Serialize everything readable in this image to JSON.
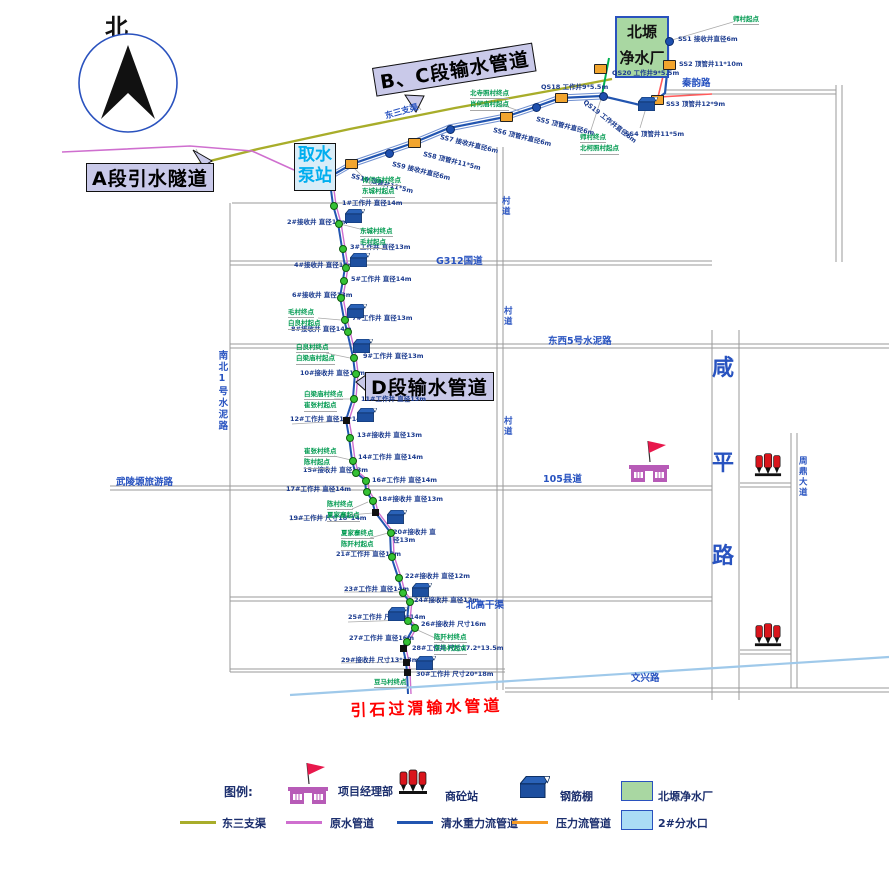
{
  "compass": {
    "label": "北"
  },
  "plant_box": {
    "line1": "北塬",
    "line2": "净水厂"
  },
  "pump_box": {
    "line1": "取水",
    "line2": "泵站"
  },
  "banners": {
    "a": "A段引水隧道",
    "bc": "B、C段输水管道",
    "d": "D段输水管道"
  },
  "red_pipeline_label": "引石过渭输水管道",
  "colors": {
    "road": "#9a9a9a",
    "clean_water": "#2255b0",
    "raw_water": "#cf6fcf",
    "pressure_map": "#ff5a5a",
    "pressure_legend": "#f59a23",
    "canal": "#a8ad2a",
    "branch_green": "#00b050",
    "yinshi": "#9fc9ea",
    "plant_green": "#a9d7a2",
    "outlet_blue": "#aadcf5",
    "label_blue": "#1b3b8f",
    "road_blue": "#2853c0",
    "village_green": "#009a50",
    "banner_fill": "#c9c9e9",
    "red_label": "#ff0000"
  },
  "ss_wells": [
    {
      "t": "SS1 接收井直径6m",
      "mx": 668,
      "my": 40,
      "lx": 678,
      "ly": 36,
      "mk": "dot",
      "rot": 0
    },
    {
      "t": "SS2 顶管井11*10m",
      "mx": 668,
      "my": 64,
      "lx": 679,
      "ly": 61,
      "mk": "box",
      "rot": 0
    },
    {
      "t": "SS3 顶管井12*9m",
      "mx": 656,
      "my": 99,
      "lx": 666,
      "ly": 101,
      "mk": "box",
      "rot": 0
    },
    {
      "t": "SS4 顶管井11*5m",
      "mx": 640,
      "my": 105,
      "lx": 625,
      "ly": 131,
      "mk": "none",
      "rot": 0
    },
    {
      "t": "QS20 工作井9*5.5m",
      "mx": 599,
      "my": 68,
      "lx": 612,
      "ly": 70,
      "mk": "box",
      "rot": 0
    },
    {
      "t": "QS19 工作井直径6m",
      "mx": 602,
      "my": 95,
      "lx": 586,
      "ly": 99,
      "mk": "dot",
      "rot": 38
    },
    {
      "t": "QS18 工作井9*5.5m",
      "mx": 560,
      "my": 97,
      "lx": 541,
      "ly": 84,
      "mk": "box",
      "rot": 0
    },
    {
      "t": "SS5 顶管井直径6m",
      "mx": 535,
      "my": 106,
      "lx": 537,
      "ly": 116,
      "mk": "dot",
      "rot": 14
    },
    {
      "t": "SS6 顶管井直径6m",
      "mx": 505,
      "my": 116,
      "lx": 494,
      "ly": 127,
      "mk": "box",
      "rot": 14
    },
    {
      "t": "SS7 接收井直径6m",
      "mx": 449,
      "my": 128,
      "lx": 441,
      "ly": 134,
      "mk": "dot",
      "rot": 14
    },
    {
      "t": "SS8 顶管井11*5m",
      "mx": 413,
      "my": 142,
      "lx": 424,
      "ly": 151,
      "mk": "box",
      "rot": 14
    },
    {
      "t": "SS9 接收井直径6m",
      "mx": 388,
      "my": 152,
      "lx": 393,
      "ly": 161,
      "mk": "dot",
      "rot": 14
    },
    {
      "t": "SS10 顶管井11*5m",
      "mx": 350,
      "my": 163,
      "lx": 352,
      "ly": 173,
      "mk": "box",
      "rot": 14
    }
  ],
  "numbered_wells": [
    {
      "t": "1#工作井  直径14m",
      "mx": 333,
      "my": 205,
      "lx": 342,
      "ly": 200,
      "mk": "g"
    },
    {
      "t": "2#接收井  直径13m",
      "mx": 338,
      "my": 223,
      "lx": 287,
      "ly": 219,
      "mk": "g"
    },
    {
      "t": "3#工作井  直径13m",
      "mx": 342,
      "my": 248,
      "lx": 350,
      "ly": 244,
      "mk": "g"
    },
    {
      "t": "4#接收井  直径14m",
      "mx": 345,
      "my": 267,
      "lx": 294,
      "ly": 262,
      "mk": "g"
    },
    {
      "t": "5#工作井  直径14m",
      "mx": 343,
      "my": 280,
      "lx": 351,
      "ly": 276,
      "mk": "g"
    },
    {
      "t": "6#接收井  直径13m",
      "mx": 340,
      "my": 297,
      "lx": 292,
      "ly": 292,
      "mk": "g"
    },
    {
      "t": "7#工作井  直径13m",
      "mx": 344,
      "my": 319,
      "lx": 352,
      "ly": 315,
      "mk": "g"
    },
    {
      "t": "8#接收井  直径14m",
      "mx": 347,
      "my": 331,
      "lx": 291,
      "ly": 326,
      "mk": "g"
    },
    {
      "t": "9#工作井  直径13m",
      "mx": 353,
      "my": 357,
      "lx": 363,
      "ly": 353,
      "mk": "g"
    },
    {
      "t": "10#接收井  直径13m",
      "mx": 355,
      "my": 373,
      "lx": 300,
      "ly": 370,
      "mk": "g"
    },
    {
      "t": "11#工作井  直径13m",
      "mx": 353,
      "my": 398,
      "lx": 361,
      "ly": 396,
      "mk": "g"
    },
    {
      "t": "12#工作井  直径18*14m",
      "mx": 346,
      "my": 420,
      "lx": 290,
      "ly": 416,
      "mk": "sq"
    },
    {
      "t": "13#接收井  直径13m",
      "mx": 349,
      "my": 437,
      "lx": 357,
      "ly": 432,
      "mk": "g"
    },
    {
      "t": "14#工作井  直径14m",
      "mx": 352,
      "my": 460,
      "lx": 358,
      "ly": 454,
      "mk": "g"
    },
    {
      "t": "15#接收井  直径13m",
      "mx": 355,
      "my": 472,
      "lx": 303,
      "ly": 467,
      "mk": "g"
    },
    {
      "t": "16#工作井  直径14m",
      "mx": 365,
      "my": 480,
      "lx": 372,
      "ly": 477,
      "mk": "g"
    },
    {
      "t": "17#工作井  直径14m",
      "mx": 366,
      "my": 491,
      "lx": 286,
      "ly": 486,
      "mk": "g"
    },
    {
      "t": "18#接收井  直径13m",
      "mx": 372,
      "my": 500,
      "lx": 378,
      "ly": 496,
      "mk": "g"
    },
    {
      "t": "19#工作井  尺寸18*14m",
      "mx": 375,
      "my": 512,
      "lx": 289,
      "ly": 515,
      "mk": "sq"
    },
    {
      "t": "20#接收井 直径13m",
      "mx": 390,
      "my": 532,
      "lx": 393,
      "ly": 528,
      "mk": "g",
      "w": 48
    },
    {
      "t": "21#工作井  直径13m",
      "mx": 391,
      "my": 556,
      "lx": 336,
      "ly": 551,
      "mk": "g"
    },
    {
      "t": "22#接收井  直径12m",
      "mx": 398,
      "my": 577,
      "lx": 405,
      "ly": 573,
      "mk": "g"
    },
    {
      "t": "23#工作井  直径14m",
      "mx": 402,
      "my": 592,
      "lx": 344,
      "ly": 586,
      "mk": "g"
    },
    {
      "t": "24#接收井  直径12m",
      "mx": 409,
      "my": 601,
      "lx": 414,
      "ly": 597,
      "mk": "g"
    },
    {
      "t": "25#工作井  尺寸19*14m",
      "mx": 407,
      "my": 620,
      "lx": 348,
      "ly": 614,
      "mk": "g"
    },
    {
      "t": "26#接收井  尺寸16m",
      "mx": 414,
      "my": 627,
      "lx": 421,
      "ly": 621,
      "mk": "g"
    },
    {
      "t": "27#工作井  直径16m",
      "mx": 406,
      "my": 641,
      "lx": 349,
      "ly": 635,
      "mk": "g"
    },
    {
      "t": "28#工作井  尺寸17.2*13.5m",
      "mx": 403,
      "my": 648,
      "lx": 412,
      "ly": 645,
      "mk": "sq"
    },
    {
      "t": "29#接收井  尺寸13*13m",
      "mx": 406,
      "my": 662,
      "lx": 341,
      "ly": 657,
      "mk": "sq"
    },
    {
      "t": "30#工作井  尺寸20*18m",
      "mx": 407,
      "my": 672,
      "lx": 416,
      "ly": 671,
      "mk": "sq"
    }
  ],
  "village_notes": [
    {
      "lines": [
        "师村起点"
      ],
      "x": 733,
      "y": 14
    },
    {
      "lines": [
        "北寺照村终点",
        "肖何庙村起点"
      ],
      "x": 470,
      "y": 88
    },
    {
      "lines": [
        "师村终点",
        "北柯照村起点"
      ],
      "x": 580,
      "y": 132
    },
    {
      "lines": [
        "肖何庙村终点",
        "东城村起点"
      ],
      "x": 362,
      "y": 175
    },
    {
      "lines": [
        "东城村终点",
        "毛村起点"
      ],
      "x": 360,
      "y": 226
    },
    {
      "lines": [
        "毛村终点",
        "白良村起点"
      ],
      "x": 288,
      "y": 307
    },
    {
      "lines": [
        "白良村终点",
        "白梁庙村起点"
      ],
      "x": 296,
      "y": 342
    },
    {
      "lines": [
        "白梁庙村终点",
        "崔张村起点"
      ],
      "x": 304,
      "y": 389
    },
    {
      "lines": [
        "崔张村终点",
        "陈村起点"
      ],
      "x": 304,
      "y": 446
    },
    {
      "lines": [
        "陈村终点",
        "夏家寨起点"
      ],
      "x": 327,
      "y": 499
    },
    {
      "lines": [
        "夏家寨终点",
        "陈阡村起点"
      ],
      "x": 341,
      "y": 528
    },
    {
      "lines": [
        "陈阡村终点",
        "豆马村起点"
      ],
      "x": 434,
      "y": 632
    },
    {
      "lines": [
        "豆马村终点"
      ],
      "x": 374,
      "y": 677
    }
  ],
  "road_labels": [
    {
      "t": "秦韵路",
      "x": 682,
      "y": 78,
      "cls": "rl"
    },
    {
      "t": "G312国道",
      "x": 436,
      "y": 256,
      "cls": "rl"
    },
    {
      "t": "村道",
      "x": 500,
      "y": 196,
      "cls": "rl rl-sm rl-v"
    },
    {
      "t": "村道",
      "x": 502,
      "y": 306,
      "cls": "rl rl-sm rl-v"
    },
    {
      "t": "村道",
      "x": 502,
      "y": 416,
      "cls": "rl rl-sm rl-v"
    },
    {
      "t": "东西5号水泥路",
      "x": 548,
      "y": 336,
      "cls": "rl"
    },
    {
      "t": "105县道",
      "x": 543,
      "y": 474,
      "cls": "rl"
    },
    {
      "t": "武陵塬旅游路",
      "x": 116,
      "y": 477,
      "cls": "rl"
    },
    {
      "t": "南北1号水泥路",
      "x": 216,
      "y": 350,
      "cls": "rl rl-v"
    },
    {
      "t": "周鼎大道",
      "x": 797,
      "y": 456,
      "cls": "rl rl-sm rl-v"
    },
    {
      "t": "北高干渠",
      "x": 466,
      "y": 600,
      "cls": "rl"
    },
    {
      "t": "文兴路",
      "x": 631,
      "y": 673,
      "cls": "rl"
    },
    {
      "t": "东三支渠",
      "x": 384,
      "y": 112,
      "cls": "rl rl-sm",
      "rot": -16
    }
  ],
  "xianping_road": [
    {
      "t": "咸",
      "x": 712,
      "y": 350
    },
    {
      "t": "平",
      "x": 712,
      "y": 445
    },
    {
      "t": "路",
      "x": 712,
      "y": 538
    }
  ],
  "sheds": [
    [
      638,
      96
    ],
    [
      345,
      208
    ],
    [
      350,
      252
    ],
    [
      347,
      303
    ],
    [
      353,
      338
    ],
    [
      357,
      407
    ],
    [
      387,
      509
    ],
    [
      412,
      582
    ],
    [
      388,
      606
    ],
    [
      416,
      655
    ]
  ],
  "icons": {
    "project_office": [
      {
        "x": 626,
        "y": 438
      }
    ],
    "concrete_stations": [
      {
        "x": 754,
        "y": 450
      },
      {
        "x": 754,
        "y": 620
      }
    ]
  },
  "road_segments": [
    [
      232,
      203,
      497,
      203
    ],
    [
      230,
      261,
      712,
      261
    ],
    [
      230,
      265,
      712,
      265
    ],
    [
      230,
      344,
      889,
      344
    ],
    [
      230,
      348,
      889,
      348
    ],
    [
      110,
      486,
      712,
      486
    ],
    [
      110,
      490,
      712,
      490
    ],
    [
      230,
      597,
      712,
      597
    ],
    [
      230,
      601,
      712,
      601
    ],
    [
      230,
      669,
      505,
      669
    ],
    [
      230,
      672,
      505,
      672
    ],
    [
      505,
      688,
      889,
      688
    ],
    [
      505,
      692,
      889,
      692
    ],
    [
      665,
      90,
      836,
      90
    ],
    [
      665,
      94,
      836,
      94
    ],
    [
      740,
      483,
      791,
      483
    ],
    [
      740,
      487,
      791,
      487
    ],
    [
      740,
      650,
      791,
      650
    ],
    [
      740,
      654,
      791,
      654
    ],
    [
      230,
      203,
      230,
      672
    ],
    [
      497,
      147,
      497,
      690
    ],
    [
      503,
      147,
      503,
      690
    ],
    [
      712,
      330,
      712,
      700
    ],
    [
      739,
      330,
      739,
      700
    ],
    [
      791,
      433,
      791,
      688
    ],
    [
      797,
      433,
      797,
      688
    ],
    [
      836,
      85,
      836,
      262
    ],
    [
      842,
      85,
      842,
      262
    ]
  ],
  "pipeline_paths": [
    {
      "d": "M198,164 L258,149 L350,129 L455,108 L560,89 L612,79",
      "c": "#a8ad2a",
      "w": 2.4,
      "n": "canal-dongsan-line"
    },
    {
      "d": "M331,173 L352,161 L413,140 L449,125 L505,114 L535,104 L560,95 L602,93",
      "c": "#6f8fd0",
      "w": 1,
      "n": "pipeline-clean-top-stripe"
    },
    {
      "d": "M331,179 L352,167 L413,146 L449,131 L505,120 L535,110 L560,101 L602,99",
      "c": "#6f8fd0",
      "w": 1,
      "n": "pipeline-clean-top-stripe"
    },
    {
      "d": "M331,176 L352,164 L413,143 L449,128 L505,117 L535,107 L560,98 L602,96 L640,105 L656,100 L665,93 L668,64 L668,42",
      "c": "#2255b0",
      "w": 2.2,
      "n": "pipeline-clean-top"
    },
    {
      "d": "M712,94 L658,97 L666,64 L668,42",
      "c": "#ff5a5a",
      "w": 1.6,
      "n": "pipeline-pressure-line"
    },
    {
      "d": "M609,58 L602,95",
      "c": "#00b050",
      "w": 2,
      "n": "pipeline-branch-line"
    },
    {
      "d": "M62,152 L190,146 L252,151 L294,170",
      "c": "#cf6fcf",
      "w": 1.6,
      "n": "pipeline-raw-west"
    },
    {
      "d": "M331,190 L333,205 L338,223 L342,248 L345,267 L343,280 L340,297 L344,319 L347,331 L353,357 L355,373 L353,398 L346,420 L349,437 L352,460 L355,472 L365,480 L366,491 L372,500 L375,512 L390,532 L391,556 L398,577 L402,592 L409,601 L407,620 L414,627 L406,641 L403,648 L406,662 L407,672 L408,694",
      "c": "#2255b0",
      "w": 2,
      "n": "pipeline-clean-main"
    },
    {
      "d": "M331,190 L333,205 L338,223 L342,248 L345,267 L343,280 L340,297 L344,319 L347,331 L353,357 L355,373 L353,398 L346,420 L349,437 L352,460 L355,472 L365,480 L366,491 L372,500 L375,512 L390,532 L391,556 L398,577 L402,592 L409,601 L407,620 L414,627 L406,641 L403,648 L406,662 L407,672 L408,694",
      "c": "#cf6fcf",
      "w": 1.4,
      "t": "translate(3,0)",
      "n": "pipeline-raw-main"
    },
    {
      "d": "M290,695 L889,657",
      "c": "#9fc9ea",
      "w": 2.2,
      "n": "pipeline-yinshi-line"
    }
  ],
  "leader_segments": [
    [
      205,
      166,
      196,
      149
    ],
    [
      412,
      97,
      421,
      110
    ],
    [
      365,
      384,
      356,
      381
    ],
    [
      733,
      22,
      672,
      40
    ],
    [
      500,
      104,
      522,
      112
    ],
    [
      590,
      133,
      601,
      99
    ],
    [
      372,
      186,
      352,
      166
    ],
    [
      372,
      232,
      340,
      224
    ],
    [
      318,
      318,
      341,
      320
    ],
    [
      326,
      353,
      350,
      358
    ],
    [
      334,
      399,
      352,
      399
    ],
    [
      334,
      456,
      351,
      460
    ],
    [
      352,
      509,
      368,
      502
    ],
    [
      370,
      538,
      388,
      533
    ],
    [
      444,
      642,
      413,
      628
    ],
    [
      400,
      684,
      408,
      676
    ],
    [
      640,
      128,
      646,
      108
    ],
    [
      348,
      622,
      407,
      620
    ],
    [
      292,
      424,
      344,
      421
    ],
    [
      290,
      520,
      373,
      513
    ],
    [
      344,
      592,
      400,
      592
    ],
    [
      341,
      663,
      404,
      662
    ]
  ],
  "pointer_polygons": [
    {
      "d": "M193,150 L203,166 L212,161 Z",
      "n": "tunnel-a-pointer"
    },
    {
      "d": "M405,95 L416,112 L424,96 Z",
      "n": "banner-bc-pointer"
    },
    {
      "d": "M356,382 L366,375 L366,391 Z",
      "n": "banner-d-pointer"
    }
  ],
  "legend": {
    "title": "图例:",
    "row1": [
      {
        "type": "building",
        "label": "项目经理部",
        "ix": 285,
        "iy": 760,
        "lx": 338,
        "ly": 783
      },
      {
        "type": "concrete",
        "label": "商砼站",
        "ix": 398,
        "iy": 766,
        "lx": 445,
        "ly": 788
      },
      {
        "type": "shed",
        "label": "钢筋棚",
        "ix": 520,
        "iy": 776,
        "lx": 560,
        "ly": 788
      },
      {
        "type": "rect",
        "color": "#a9d7a2",
        "label": "北塬净水厂",
        "ix": 621,
        "iy": 781,
        "lx": 658,
        "ly": 788
      }
    ],
    "row2": [
      {
        "type": "line",
        "color": "#a8ad2a",
        "label": "东三支渠",
        "ix": 180,
        "iy": 821,
        "lx": 222,
        "ly": 815
      },
      {
        "type": "line",
        "color": "#cf6fcf",
        "label": "原水管道",
        "ix": 286,
        "iy": 821,
        "lx": 330,
        "ly": 815
      },
      {
        "type": "line",
        "color": "#2255b0",
        "label": "清水重力流管道",
        "ix": 397,
        "iy": 821,
        "lx": 441,
        "ly": 815
      },
      {
        "type": "line",
        "color": "#f59a23",
        "label": "压力流管道",
        "ix": 512,
        "iy": 821,
        "lx": 556,
        "ly": 815
      },
      {
        "type": "rect",
        "color": "#aadcf5",
        "label": "2#分水口",
        "ix": 621,
        "iy": 810,
        "lx": 658,
        "ly": 815
      }
    ]
  }
}
